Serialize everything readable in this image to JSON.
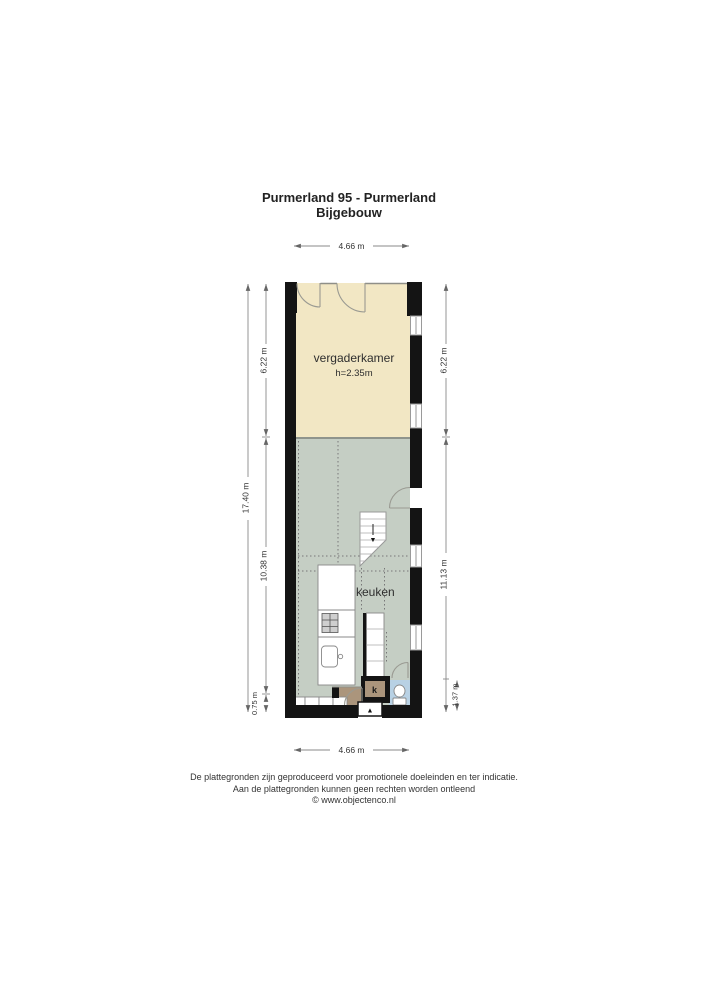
{
  "title": {
    "line1": "Purmerland 95 - Purmerland",
    "line2": "Bijgebouw"
  },
  "plan": {
    "rooms": {
      "vergaderkamer": {
        "label": "vergaderkamer",
        "ceiling_height": "h=2.35m"
      },
      "keuken": {
        "label": "keuken"
      },
      "kast": {
        "label": "k"
      }
    },
    "icons": {
      "stairs_arrow": "▼",
      "entrance_arrow": "▲"
    }
  },
  "dimensions": {
    "top": "4.66 m",
    "bottom": "4.66 m",
    "left_total": "17.40 m",
    "left_upper": "6.22 m",
    "left_middle": "10.38 m",
    "left_lower": "0.75 m",
    "right_upper": "6.22 m",
    "right_middle": "11.13 m",
    "right_lower": "1.37 m"
  },
  "footer": {
    "line1": "De plattegronden zijn geproduceerd voor promotionele doeleinden en ter indicatie.",
    "line2": "Aan de plattegronden kunnen geen rechten worden ontleend",
    "line3": "© www.objectenco.nl"
  },
  "colors": {
    "vergaderkamer_fill": "#f2e7c4",
    "living_kitchen_fill": "#c5cec4",
    "toilet_fill": "#b8d1e4",
    "hall_fill": "#ab957c",
    "wall": "#141414",
    "dimension_line": "#8a8a8a"
  }
}
